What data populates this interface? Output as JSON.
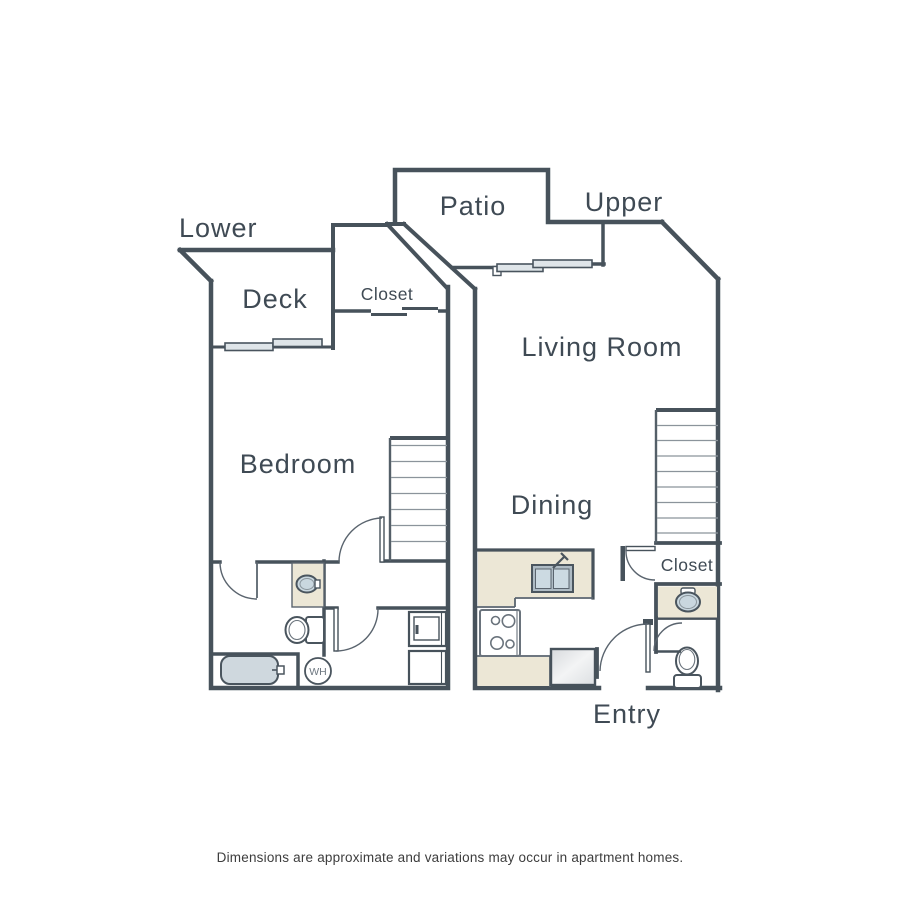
{
  "floorplan": {
    "units": {
      "lower": {
        "label": "Lower",
        "rooms": {
          "deck": "Deck",
          "closet": "Closet",
          "bedroom": "Bedroom"
        },
        "fixtures": {
          "water_heater": "WH",
          "bathtub": "bathtub",
          "toilet": "toilet",
          "sink": "sink",
          "washer": "washer",
          "dryer": "dryer",
          "stairs": "stairs"
        }
      },
      "upper": {
        "label": "Upper",
        "rooms": {
          "patio": "Patio",
          "living_room": "Living Room",
          "dining": "Dining",
          "closet": "Closet",
          "entry": "Entry"
        },
        "fixtures": {
          "kitchen_sink": "double sink",
          "range": "range",
          "refrigerator": "refrigerator",
          "vanity_sink": "sink",
          "toilet": "toilet",
          "stairs": "stairs"
        }
      }
    },
    "colors": {
      "wall": "#47525b",
      "label_text": "#3f4a54",
      "counter_fill": "#ece7d6",
      "window_fill": "#dfe5e9",
      "fixture_fill": "#c9d7df",
      "tub_fill": "#cfd8de",
      "tread_line": "#8b949b",
      "disclaimer_text": "#3d3d3d"
    }
  },
  "disclaimer": "Dimensions are approximate and variations may occur in apartment homes."
}
